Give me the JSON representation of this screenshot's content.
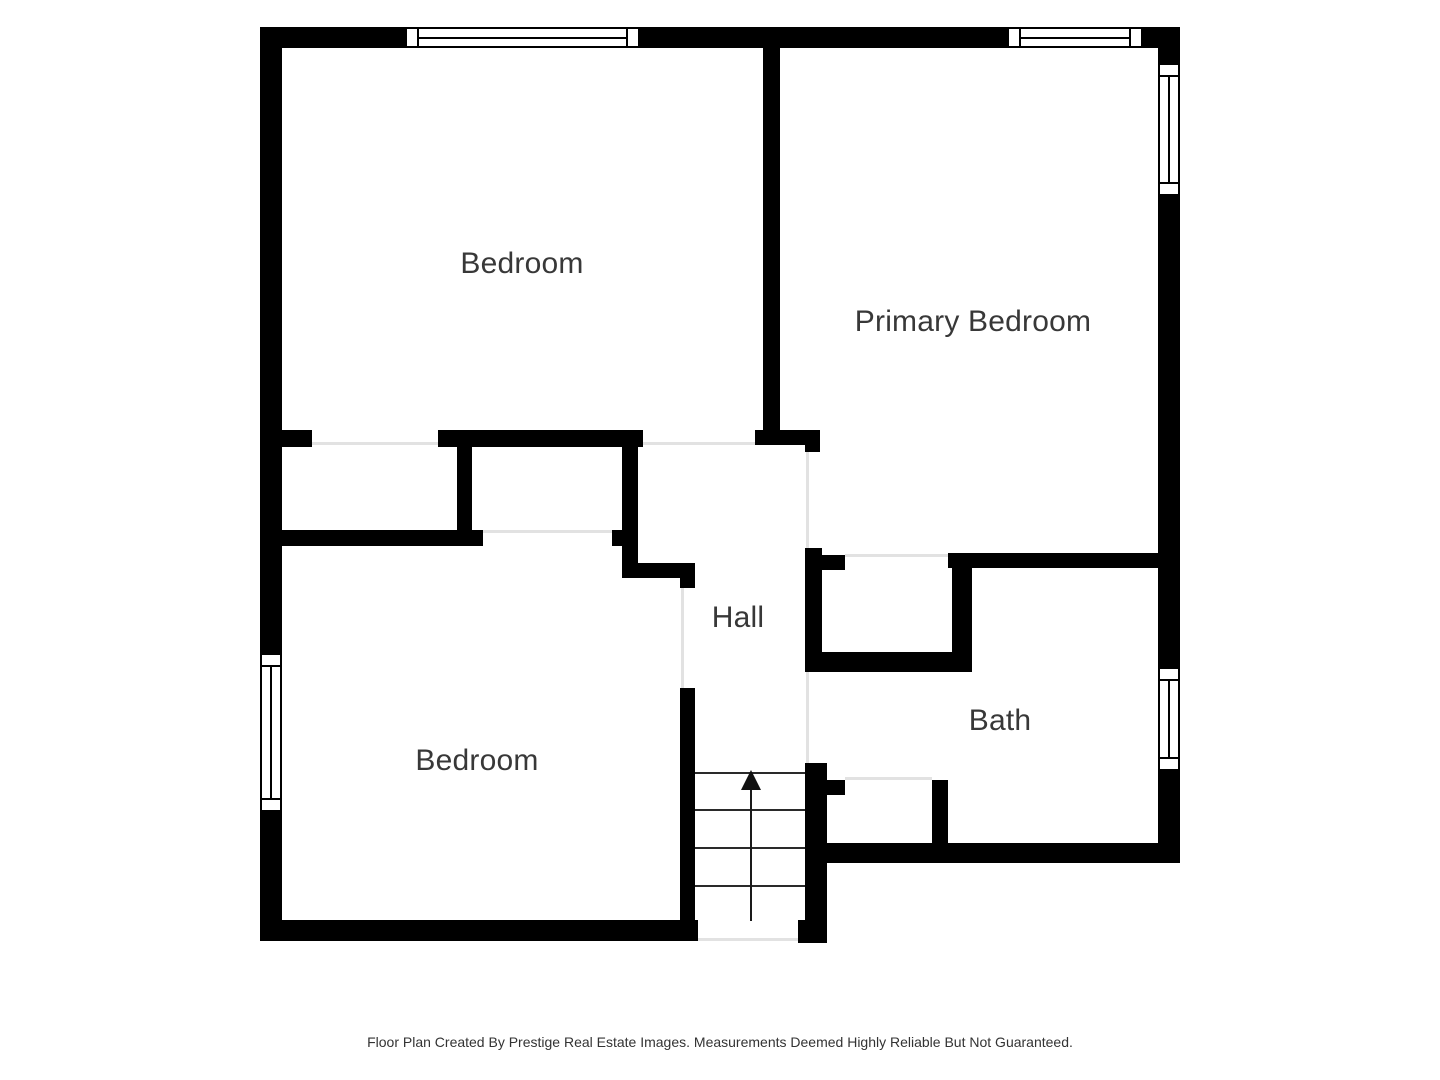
{
  "canvas": {
    "width": 1440,
    "height": 1080,
    "background": "#ffffff"
  },
  "colors": {
    "wall": "#000000",
    "opening_line": "#e2e2e2",
    "stair_tread": "#2a2a2a",
    "room_label": "#383838",
    "footer_text": "#333333"
  },
  "rooms": [
    {
      "id": "bedroom-top",
      "label": "Bedroom",
      "cx": 522,
      "cy": 264
    },
    {
      "id": "primary-bedroom",
      "label": "Primary Bedroom",
      "cx": 973,
      "cy": 322
    },
    {
      "id": "hall",
      "label": "Hall",
      "cx": 738,
      "cy": 618
    },
    {
      "id": "bedroom-bottom",
      "label": "Bedroom",
      "cx": 477,
      "cy": 761
    },
    {
      "id": "bath",
      "label": "Bath",
      "cx": 1000,
      "cy": 721
    }
  ],
  "walls": [
    [
      260,
      27,
      920,
      21
    ],
    [
      260,
      27,
      22,
      914
    ],
    [
      1158,
      27,
      22,
      836
    ],
    [
      260,
      920,
      438,
      21
    ],
    [
      820,
      843,
      360,
      20
    ],
    [
      763,
      48,
      17,
      382
    ],
    [
      282,
      430,
      30,
      17
    ],
    [
      438,
      430,
      205,
      17
    ],
    [
      755,
      430,
      65,
      15
    ],
    [
      457,
      447,
      15,
      85
    ],
    [
      282,
      530,
      201,
      16
    ],
    [
      612,
      530,
      11,
      16
    ],
    [
      622,
      447,
      16,
      131
    ],
    [
      622,
      563,
      73,
      15
    ],
    [
      680,
      563,
      15,
      25
    ],
    [
      680,
      688,
      15,
      232
    ],
    [
      805,
      445,
      15,
      7
    ],
    [
      805,
      548,
      17,
      124
    ],
    [
      820,
      555,
      25,
      15
    ],
    [
      948,
      553,
      212,
      15
    ],
    [
      952,
      568,
      20,
      104
    ],
    [
      805,
      652,
      167,
      20
    ],
    [
      805,
      763,
      22,
      180
    ],
    [
      798,
      920,
      29,
      23
    ],
    [
      820,
      780,
      25,
      15
    ],
    [
      932,
      780,
      16,
      65
    ]
  ],
  "openings": [
    [
      312,
      442,
      126,
      3
    ],
    [
      643,
      442,
      112,
      3
    ],
    [
      483,
      530,
      129,
      3
    ],
    [
      681,
      588,
      3,
      100
    ],
    [
      806,
      452,
      3,
      96
    ],
    [
      845,
      554,
      103,
      3
    ],
    [
      845,
      777,
      87,
      3
    ],
    [
      806,
      672,
      3,
      91
    ],
    [
      698,
      938,
      100,
      3
    ]
  ],
  "windows": [
    {
      "x": 405,
      "y": 27,
      "w": 235,
      "h": 21,
      "orient": "h"
    },
    {
      "x": 1007,
      "y": 27,
      "w": 136,
      "h": 21,
      "orient": "h"
    },
    {
      "x": 1158,
      "y": 63,
      "w": 22,
      "h": 133,
      "orient": "v"
    },
    {
      "x": 1158,
      "y": 667,
      "w": 22,
      "h": 104,
      "orient": "v"
    },
    {
      "x": 260,
      "y": 653,
      "w": 22,
      "h": 159,
      "orient": "v"
    }
  ],
  "stairs": {
    "treads": [
      [
        695,
        772,
        110
      ],
      [
        695,
        809,
        110
      ],
      [
        695,
        847,
        110
      ],
      [
        695,
        885,
        110
      ]
    ],
    "arrow": {
      "shaft_x": 750,
      "shaft_top": 788,
      "shaft_bottom": 921,
      "head_tip_y": 770,
      "head_cx": 751
    }
  },
  "footer": {
    "text": "Floor Plan Created By Prestige Real Estate Images. Measurements Deemed Highly Reliable But Not Guaranteed."
  }
}
